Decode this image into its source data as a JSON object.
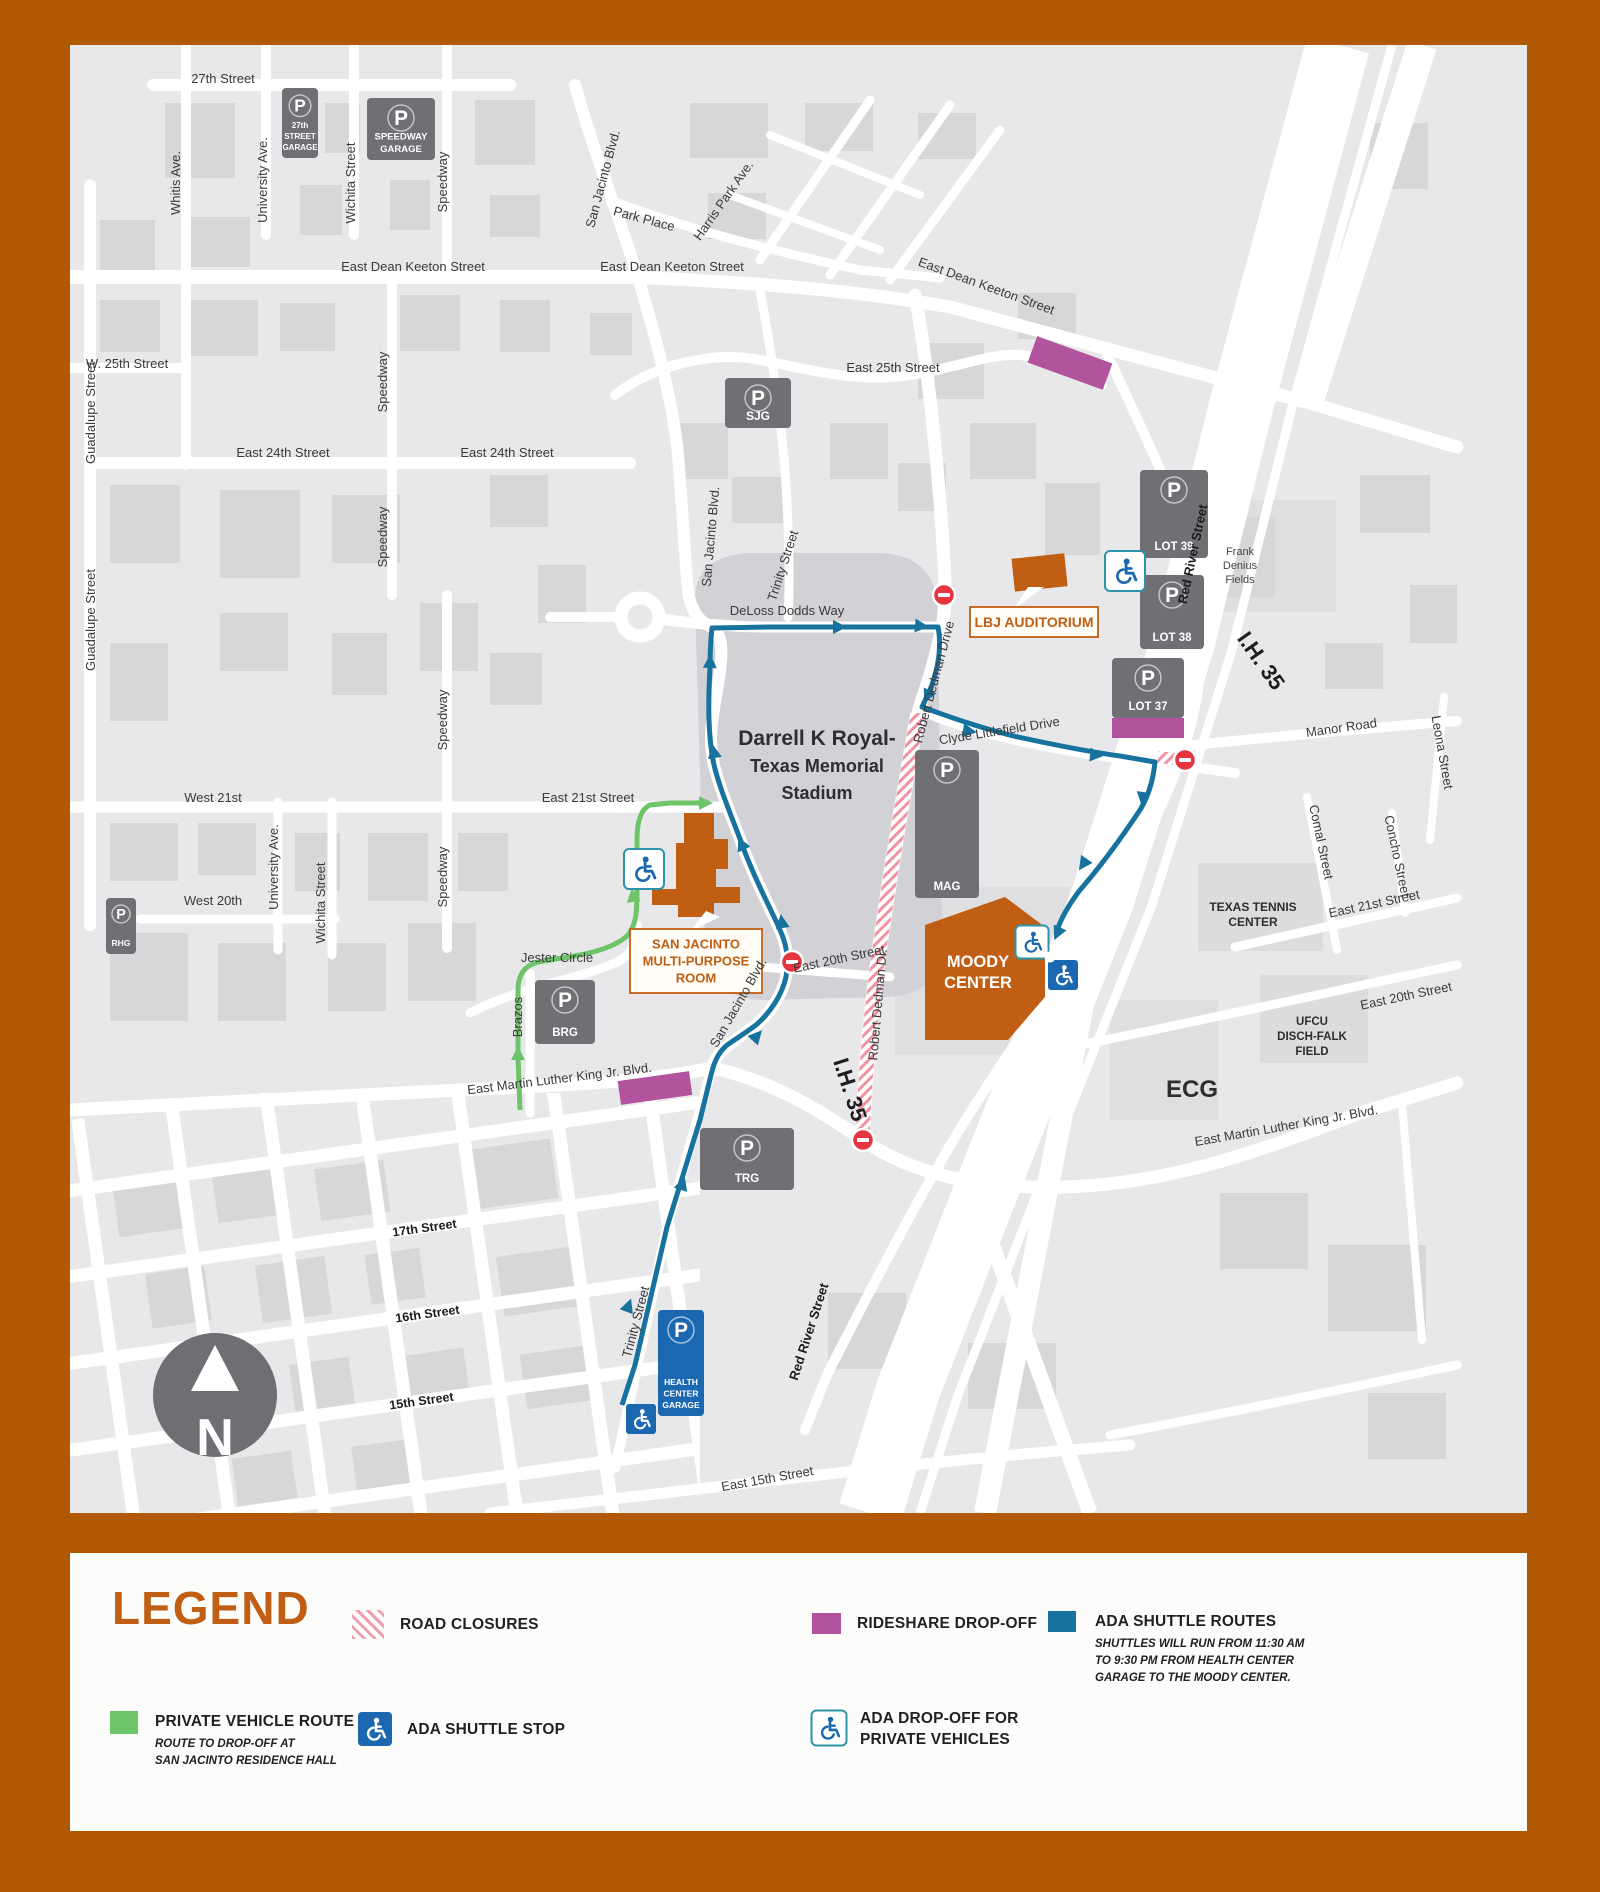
{
  "colors": {
    "frame": "#b05802",
    "map_bg": "#e8e8ea",
    "building": "#d7d7da",
    "stadium": "#d2d2d6",
    "road": "#ffffff",
    "garage": "#6f6f74",
    "blue_garage": "#1b67b0",
    "route_blue": "#17739e",
    "route_green": "#6ec468",
    "orange": "#c05e13",
    "purple": "#b2539d",
    "closure_pink": "#ef93a4",
    "noentry_red": "#e53540",
    "teal_border": "#2d93a8"
  },
  "compass": {
    "letter": "N"
  },
  "map": {
    "p_glyph": "P",
    "street_labels": [
      {
        "t": "27th Street",
        "x": 153,
        "y": 38
      },
      {
        "t": "Whitis Ave.",
        "x": 110,
        "y": 138,
        "r": -90
      },
      {
        "t": "University Ave.",
        "x": 197,
        "y": 135,
        "r": -90
      },
      {
        "t": "Wichita Street",
        "x": 285,
        "y": 138,
        "r": -90
      },
      {
        "t": "Speedway",
        "x": 377,
        "y": 137,
        "r": -90
      },
      {
        "t": "East Dean Keeton Street",
        "x": 343,
        "y": 226
      },
      {
        "t": "East Dean Keeton Street",
        "x": 602,
        "y": 226
      },
      {
        "t": "East Dean Keeton Street",
        "x": 915,
        "y": 245,
        "r": 20
      },
      {
        "t": "W. 25th Street",
        "x": 57,
        "y": 323
      },
      {
        "t": "Guadalupe Street",
        "x": 25,
        "y": 368,
        "r": -90
      },
      {
        "t": "Guadalupe Street",
        "x": 25,
        "y": 575,
        "r": -90
      },
      {
        "t": "East 24th Street",
        "x": 213,
        "y": 412
      },
      {
        "t": "East 24th Street",
        "x": 437,
        "y": 412
      },
      {
        "t": "Speedway",
        "x": 317,
        "y": 337,
        "r": -90
      },
      {
        "t": "Speedway",
        "x": 317,
        "y": 492,
        "r": -90
      },
      {
        "t": "Speedway",
        "x": 377,
        "y": 675,
        "r": -90
      },
      {
        "t": "Speedway",
        "x": 377,
        "y": 832,
        "r": -90
      },
      {
        "t": "East 25th Street",
        "x": 823,
        "y": 327
      },
      {
        "t": "San Jacinto Blvd.",
        "x": 537,
        "y": 135,
        "r": -75
      },
      {
        "t": "Park Place",
        "x": 573,
        "y": 178,
        "r": 15
      },
      {
        "t": "Harris Park Ave.",
        "x": 657,
        "y": 158,
        "r": -55
      },
      {
        "t": "San Jacinto Blvd.",
        "x": 645,
        "y": 492,
        "r": -85
      },
      {
        "t": "Trinity Street",
        "x": 717,
        "y": 522,
        "r": -72
      },
      {
        "t": "DeLoss Dodds Way",
        "x": 717,
        "y": 570
      },
      {
        "t": "Robert Dedman Drive",
        "x": 868,
        "y": 638,
        "r": -75
      },
      {
        "t": "Clyde Littlefield Drive",
        "x": 930,
        "y": 690,
        "r": -9
      },
      {
        "t": "Red River Street",
        "x": 1127,
        "y": 510,
        "r": -78,
        "w": "bold"
      },
      {
        "t": "I.H. 35",
        "x": 1185,
        "y": 620,
        "r": 55,
        "s": 22,
        "w": "bold"
      },
      {
        "t": "I.H. 35",
        "x": 773,
        "y": 1047,
        "r": 72,
        "s": 22,
        "w": "bold"
      },
      {
        "t": "Manor Road",
        "x": 1272,
        "y": 687,
        "r": -8
      },
      {
        "t": "Leona Street",
        "x": 1368,
        "y": 708,
        "r": 80
      },
      {
        "t": "Comal Street",
        "x": 1247,
        "y": 798,
        "r": 78
      },
      {
        "t": "Concho Street",
        "x": 1323,
        "y": 812,
        "r": 78
      },
      {
        "t": "East 21st Street",
        "x": 1305,
        "y": 863,
        "r": -12
      },
      {
        "t": "East 20th Street",
        "x": 1337,
        "y": 955,
        "r": -12
      },
      {
        "t": "East Martin Luther King Jr. Blvd.",
        "x": 1217,
        "y": 1085,
        "r": -10
      },
      {
        "t": "West 21st",
        "x": 143,
        "y": 757
      },
      {
        "t": "East 21st Street",
        "x": 518,
        "y": 757
      },
      {
        "t": "University Ave.",
        "x": 208,
        "y": 822,
        "r": -90
      },
      {
        "t": "Wichita Street",
        "x": 255,
        "y": 858,
        "r": -90
      },
      {
        "t": "West 20th",
        "x": 143,
        "y": 860
      },
      {
        "t": "Jester Circle",
        "x": 487,
        "y": 917
      },
      {
        "t": "Brazos",
        "x": 452,
        "y": 972,
        "r": -90
      },
      {
        "t": "East Martin Luther King Jr. Blvd.",
        "x": 490,
        "y": 1038,
        "r": -7
      },
      {
        "t": "East 20th Street",
        "x": 770,
        "y": 918,
        "r": -12
      },
      {
        "t": "Robert Dedman Dr.",
        "x": 812,
        "y": 960,
        "r": -85
      },
      {
        "t": "San Jacinto Blvd.",
        "x": 672,
        "y": 960,
        "r": -60
      },
      {
        "t": "17th Street",
        "x": 355,
        "y": 1187,
        "r": -8,
        "w": "bold",
        "s": 12.5
      },
      {
        "t": "16th Street",
        "x": 358,
        "y": 1273,
        "r": -8,
        "w": "bold",
        "s": 12.5
      },
      {
        "t": "15th Street",
        "x": 352,
        "y": 1360,
        "r": -8,
        "w": "bold",
        "s": 12.5
      },
      {
        "t": "Trinity Street",
        "x": 570,
        "y": 1278,
        "r": -75
      },
      {
        "t": "Red River Street",
        "x": 743,
        "y": 1288,
        "r": -72,
        "w": "bold"
      },
      {
        "t": "East 15th Street",
        "x": 698,
        "y": 1438,
        "r": -10
      }
    ],
    "garages": [
      {
        "lines": [
          "27th",
          "STREET",
          "GARAGE"
        ],
        "x": 212,
        "y": 43,
        "w": 36,
        "h": 70,
        "fs": 8
      },
      {
        "lines": [
          "SPEEDWAY",
          "GARAGE"
        ],
        "x": 297,
        "y": 53,
        "w": 68,
        "h": 62,
        "fs": 9.5
      },
      {
        "lines": [
          "SJG"
        ],
        "x": 655,
        "y": 333,
        "w": 66,
        "h": 50,
        "fs": 12
      },
      {
        "lines": [
          "LOT 39"
        ],
        "x": 1070,
        "y": 425,
        "w": 68,
        "h": 88,
        "fs": 11.5
      },
      {
        "lines": [
          "LOT 38"
        ],
        "x": 1070,
        "y": 530,
        "w": 64,
        "h": 74,
        "fs": 11.5
      },
      {
        "lines": [
          "LOT 37"
        ],
        "x": 1042,
        "y": 613,
        "w": 72,
        "h": 60,
        "fs": 11.5
      },
      {
        "lines": [
          "MAG"
        ],
        "x": 845,
        "y": 705,
        "w": 64,
        "h": 148,
        "fs": 11.5
      },
      {
        "lines": [
          "RHG"
        ],
        "x": 36,
        "y": 853,
        "w": 30,
        "h": 56,
        "fs": 8.5
      },
      {
        "lines": [
          "BRG"
        ],
        "x": 465,
        "y": 935,
        "w": 60,
        "h": 64,
        "fs": 11.5
      },
      {
        "lines": [
          "TRG"
        ],
        "x": 630,
        "y": 1083,
        "w": 94,
        "h": 62,
        "fs": 11.5
      },
      {
        "lines": [
          "HEALTH",
          "CENTER",
          "GARAGE"
        ],
        "x": 588,
        "y": 1265,
        "w": 46,
        "h": 106,
        "style": "blue",
        "fs": 8.5
      }
    ],
    "places": [
      {
        "lines": [
          "Darrell K Royal-",
          "Texas Memorial",
          "Stadium"
        ],
        "x": 747,
        "y": 700,
        "fs": 18,
        "fs0": 21,
        "lh": 27,
        "w": "bold",
        "c": "#2e2e30"
      },
      {
        "lines": [
          "MOODY",
          "CENTER"
        ],
        "x": 908,
        "y": 922,
        "fs": 16.5,
        "lh": 21,
        "w": "bold",
        "c": "#ffffff"
      },
      {
        "lines": [
          "TEXAS TENNIS",
          "CENTER"
        ],
        "x": 1183,
        "y": 866,
        "fs": 12,
        "lh": 15,
        "w": "bold",
        "c": "#2e2e30"
      },
      {
        "lines": [
          "UFCU",
          "DISCH-FALK",
          "FIELD"
        ],
        "x": 1242,
        "y": 980,
        "fs": 11.5,
        "lh": 15,
        "w": "bold",
        "c": "#2e2e30"
      },
      {
        "lines": [
          "ECG"
        ],
        "x": 1122,
        "y": 1052,
        "fs": 24,
        "lh": 26,
        "w": "bold",
        "c": "#2e2e30"
      },
      {
        "lines": [
          "Frank",
          "Denius",
          "Fields"
        ],
        "x": 1170,
        "y": 510,
        "fs": 11,
        "lh": 14,
        "c": "#454548"
      }
    ],
    "callouts": [
      {
        "lines": [
          "LBJ AUDITORIUM"
        ],
        "x": 900,
        "y": 562,
        "w": 128,
        "h": 30,
        "fs": 14
      },
      {
        "lines": [
          "SAN JACINTO",
          "MULTI-PURPOSE",
          "ROOM"
        ],
        "x": 560,
        "y": 884,
        "w": 132,
        "h": 64,
        "fs": 13
      }
    ],
    "icons": [
      {
        "type": "noentry",
        "x": 874,
        "y": 550
      },
      {
        "type": "noentry",
        "x": 1115,
        "y": 715
      },
      {
        "type": "noentry",
        "x": 722,
        "y": 917
      },
      {
        "type": "noentry",
        "x": 793,
        "y": 1095
      },
      {
        "type": "ada-white",
        "x": 574,
        "y": 824,
        "s": 40
      },
      {
        "type": "ada-white",
        "x": 1055,
        "y": 526,
        "s": 40
      },
      {
        "type": "ada-white",
        "x": 962,
        "y": 897,
        "s": 33
      },
      {
        "type": "ada-blue",
        "x": 993,
        "y": 930,
        "s": 30
      },
      {
        "type": "ada-blue",
        "x": 571,
        "y": 1374,
        "s": 30
      }
    ],
    "rideshare_zones": [
      {
        "x": 1000,
        "y": 318,
        "w": 80,
        "h": 28,
        "r": 20
      },
      {
        "x": 585,
        "y": 1043,
        "w": 72,
        "h": 24,
        "r": -8
      },
      {
        "x": 1078,
        "y": 683,
        "w": 72,
        "h": 20,
        "r": 0
      }
    ]
  },
  "legend": {
    "title": "LEGEND",
    "items": [
      {
        "id": "road-closures",
        "label": "ROAD CLOSURES",
        "swatch": "hatch"
      },
      {
        "id": "rideshare-dropoff",
        "label": "RIDESHARE DROP-OFF",
        "swatch": "purple"
      },
      {
        "id": "ada-shuttle-routes",
        "label": "ADA SHUTTLE ROUTES",
        "swatch": "blue",
        "note": [
          "SHUTTLES WILL RUN FROM 11:30 AM",
          "TO 9:30 PM FROM HEALTH CENTER",
          "GARAGE TO THE MOODY CENTER."
        ]
      },
      {
        "id": "private-vehicle-route",
        "label": "PRIVATE VEHICLE ROUTE",
        "swatch": "green",
        "note": [
          "ROUTE TO DROP-OFF AT",
          "SAN JACINTO RESIDENCE HALL"
        ]
      },
      {
        "id": "ada-shuttle-stop",
        "label": "ADA SHUTTLE STOP",
        "swatch": "ada-blue"
      },
      {
        "id": "ada-dropoff",
        "label": [
          "ADA DROP-OFF FOR",
          "PRIVATE VEHICLES"
        ],
        "swatch": "ada-white"
      }
    ]
  }
}
